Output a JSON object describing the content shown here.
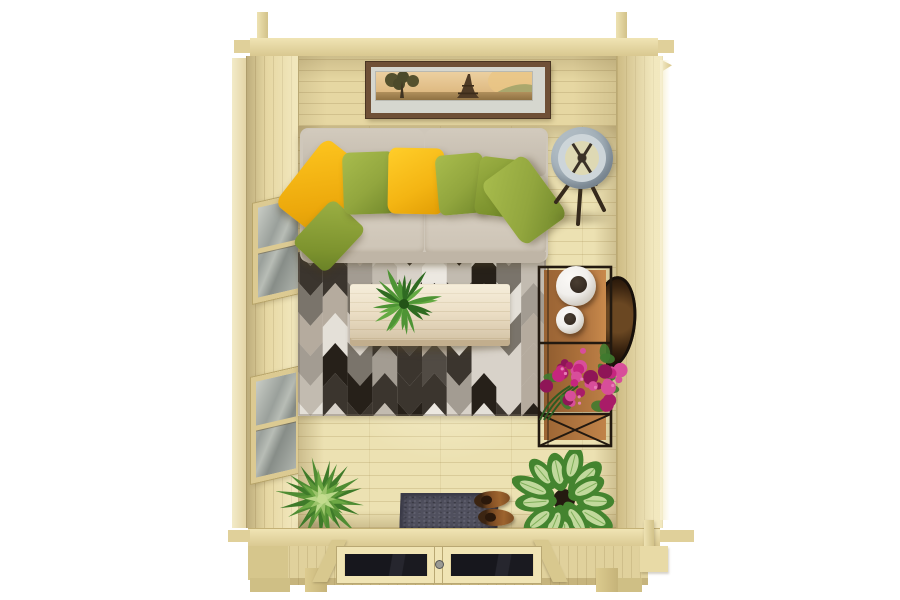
{
  "meta": {
    "title": "Top-down 3D render of a wooden garden log cabin interior on a white background",
    "canvas": {
      "width": 900,
      "height": 600
    }
  },
  "colors": {
    "bg": "#ffffff",
    "wood_top": "#f0e4b4",
    "wood": "#e6d7a2",
    "wood_shade": "#d9c890",
    "wood_line": "#b9a873",
    "wood_pale": "#f6efd0",
    "floor": "#ece1b2",
    "sofa_base": "#cfc7ba",
    "sofa_back": "#c9c1b3",
    "sofa_seat": "#d8d0c4",
    "sofa_front": "#bfb5a6",
    "yellow": "#f4b513",
    "green": "#92a63e",
    "rug_bg": "#dcd7cf",
    "table": "#ecdfc6",
    "table_edge": "#c9b795",
    "lamp": "#a2b1ba",
    "lamp_in": "#cdd5d9",
    "metal": "#2c2117",
    "shelf_wood": "#a86e3c",
    "vase": "#f1efec",
    "vase_hole": "#352b22",
    "tray": "#3a2410",
    "flower": "#c6267f",
    "leaf": "#3f7a2f",
    "mat": "#50505e",
    "mat_edge": "#3b3b48",
    "boot": "#8b5527",
    "boot_dark": "#3c2512",
    "pframe": "#6f5036",
    "pmat": "#d6d7cf"
  },
  "objects": {
    "cabin": {
      "label": "Wooden log cabin seen from above"
    },
    "picture": {
      "label": "Framed sepia Eiffel Tower panorama on back wall"
    },
    "sofa": {
      "label": "Beige two-seat sofa with yellow and olive-green cushions"
    },
    "rug": {
      "label": "Black, grey and white chevron area rug"
    },
    "table": {
      "label": "Light whitewashed wood coffee table"
    },
    "fern": {
      "label": "Green fern on coffee table"
    },
    "lamp": {
      "label": "Tripod floor lamp with grey drum shade"
    },
    "shelf": {
      "label": "Black metal shelving unit with wooden shelves"
    },
    "vases": {
      "label": "Two round white vases with dark openings"
    },
    "tray": {
      "label": "Dark round tray leaning against right wall"
    },
    "flowers": {
      "label": "Magenta flowering plant on shelf"
    },
    "bromeliad": {
      "label": "Spiky green plant near front wall"
    },
    "dieffenbachia": {
      "label": "Variegated leafy plant near front wall"
    },
    "doormat": {
      "label": "Dark grey doormat"
    },
    "boots": {
      "label": "Pair of brown boots on doormat"
    },
    "windows": {
      "label": "Two glazed windows in left wall"
    },
    "doors": {
      "label": "Glazed double entrance doors in front wall"
    }
  },
  "decor": {
    "rug": {
      "w": 248,
      "h": 164,
      "columns": 10,
      "bg": "#dcd7cf",
      "palette": [
        "#ece8e1",
        "#d8d2c9",
        "#c2bbb0",
        "#a39c92",
        "#7a746b",
        "#514b44",
        "#262019",
        "#b5ab9e",
        "#e4e0d8",
        "#3b352e"
      ]
    },
    "fern": {
      "cx": 44,
      "cy": 36,
      "r": 40,
      "fronds": 22,
      "colors": [
        "#2f6b22",
        "#4e9435",
        "#63aa42"
      ]
    },
    "bromeliad": {
      "cx": 46,
      "cy": 45,
      "rings": [
        [
          20,
          44,
          5
        ],
        [
          14,
          28,
          5
        ],
        [
          10,
          17,
          4
        ]
      ],
      "ringColors": [
        [
          "#4f8c33",
          "#3e7a29"
        ],
        [
          "#6da844",
          "#5c9638"
        ],
        [
          "#9cc46b",
          "#b9d788"
        ]
      ],
      "center": "#c3dc8e"
    },
    "dieffenbachia": {
      "cx": 52,
      "cy": 50,
      "leaves": 13,
      "edge": "#44842f",
      "center": "#cfe2a9",
      "vein": "#7fae58",
      "pot": "#241a10"
    },
    "flowers": {
      "cx": 46,
      "cy": 38,
      "rx": 40,
      "ry": 32,
      "count": 30,
      "petals": [
        "#c6267f",
        "#a91c68",
        "#d84e9a",
        "#8f1557"
      ],
      "leaf": "#3f7a2f",
      "stem": "#2e5b22"
    },
    "lampLegs": {
      "x0": 42,
      "y0": 8,
      "legs": [
        [
          -26,
          36
        ],
        [
          -4,
          58
        ],
        [
          22,
          44
        ],
        [
          14,
          18
        ]
      ],
      "color": "#362a1c"
    }
  }
}
